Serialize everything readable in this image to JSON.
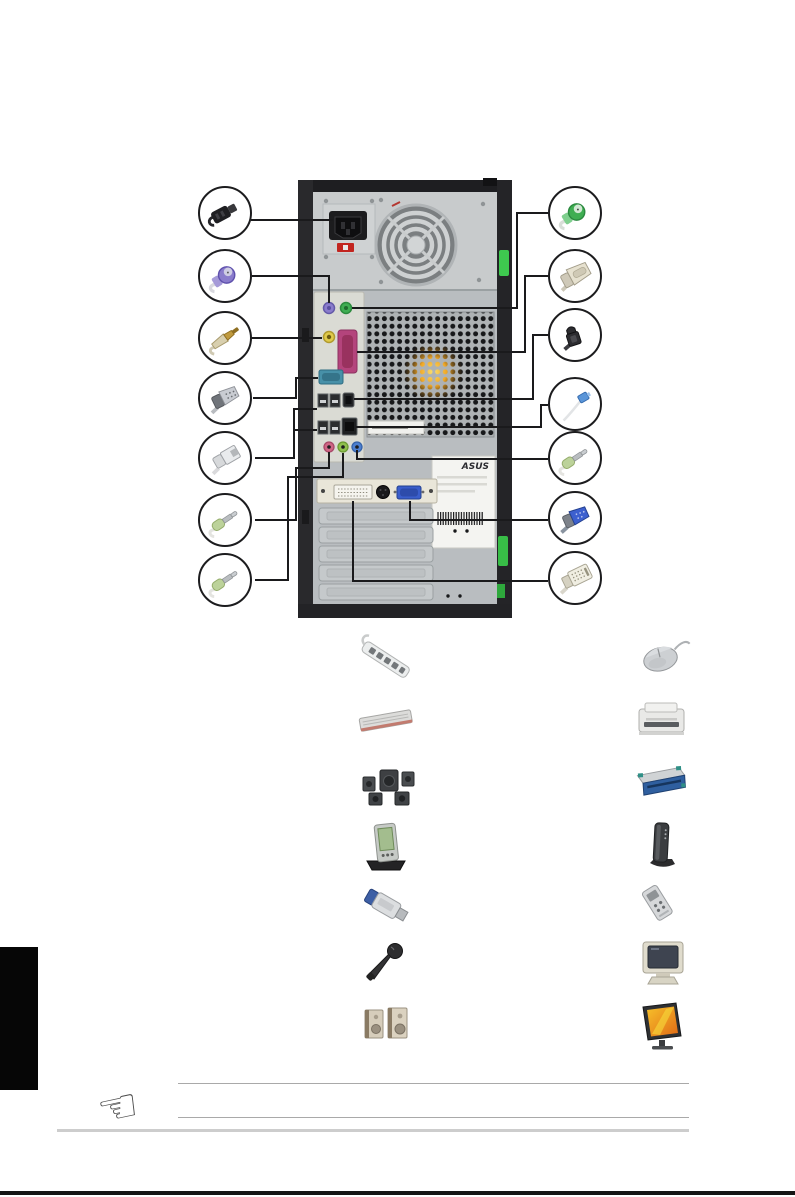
{
  "page": {
    "background_color": "#ffffff",
    "description_icon": "rear-panel-connection-diagram"
  },
  "rear_panel": {
    "tower": {
      "asus_label_text": "ASUS",
      "chassis_color": "#2a2a2c",
      "panel_color": "#b9bdc0",
      "psu_color": "#c8cbcc",
      "latch_color": "#3ec94f",
      "cpu_fan_glow_color": "#f0a828",
      "ports": [
        {
          "name": "ac-power-inlet",
          "color": "#1c1c1e"
        },
        {
          "name": "ps2-keyboard-port",
          "color": "#8a7ccc"
        },
        {
          "name": "ps2-mouse-port",
          "color": "#3fae52"
        },
        {
          "name": "spdif-coaxial-port",
          "color": "#e0ca4a"
        },
        {
          "name": "parallel-port",
          "color": "#b4447c"
        },
        {
          "name": "serial-port",
          "color": "#4790a8"
        },
        {
          "name": "usb-ports",
          "color": "#2b2d2f"
        },
        {
          "name": "ieee1394-port",
          "color": "#232527"
        },
        {
          "name": "lan-port",
          "color": "#1e2022"
        },
        {
          "name": "mic-jack",
          "color": "#cf6585"
        },
        {
          "name": "line-out-jack",
          "color": "#8fbf4e"
        },
        {
          "name": "line-in-jack",
          "color": "#4c7fd0"
        },
        {
          "name": "dvi-port",
          "color": "#f5f4ee"
        },
        {
          "name": "s-video-port",
          "color": "#1a1a1c"
        },
        {
          "name": "vga-port",
          "color": "#3a5ecb"
        }
      ]
    },
    "left_callouts": [
      {
        "icon": "power-cord-plug-icon"
      },
      {
        "icon": "ps2-keyboard-connector-icon"
      },
      {
        "icon": "spdif-coaxial-plug-icon"
      },
      {
        "icon": "serial-db9-connector-icon"
      },
      {
        "icon": "usb-plug-icon"
      },
      {
        "icon": "audio-minijack-plug-icon"
      },
      {
        "icon": "audio-minijack-plug-icon"
      }
    ],
    "right_callouts": [
      {
        "icon": "ps2-mouse-connector-icon"
      },
      {
        "icon": "parallel-db25-connector-icon"
      },
      {
        "icon": "ieee1394-plug-icon"
      },
      {
        "icon": "lan-rj45-plug-icon"
      },
      {
        "icon": "audio-minijack-plug-icon"
      },
      {
        "icon": "vga-connector-icon"
      },
      {
        "icon": "dvi-connector-icon"
      }
    ]
  },
  "peripherals": {
    "left_column": [
      {
        "icon": "power-strip-icon"
      },
      {
        "icon": "keyboard-icon"
      },
      {
        "icon": "surround-speaker-set-icon"
      },
      {
        "icon": "pda-with-cradle-icon"
      },
      {
        "icon": "usb-flash-drive-icon"
      },
      {
        "icon": "microphone-icon"
      },
      {
        "icon": "stereo-speakers-icon"
      }
    ],
    "right_column": [
      {
        "icon": "mouse-icon"
      },
      {
        "icon": "printer-icon"
      },
      {
        "icon": "external-drive-icon"
      },
      {
        "icon": "modem-icon"
      },
      {
        "icon": "portable-camera-device-icon"
      },
      {
        "icon": "crt-monitor-icon"
      },
      {
        "icon": "lcd-monitor-icon"
      }
    ]
  },
  "footer": {
    "note_icon": "pointing-hand-icon",
    "note_hand_glyph": "☜",
    "note_line_count": "2"
  }
}
